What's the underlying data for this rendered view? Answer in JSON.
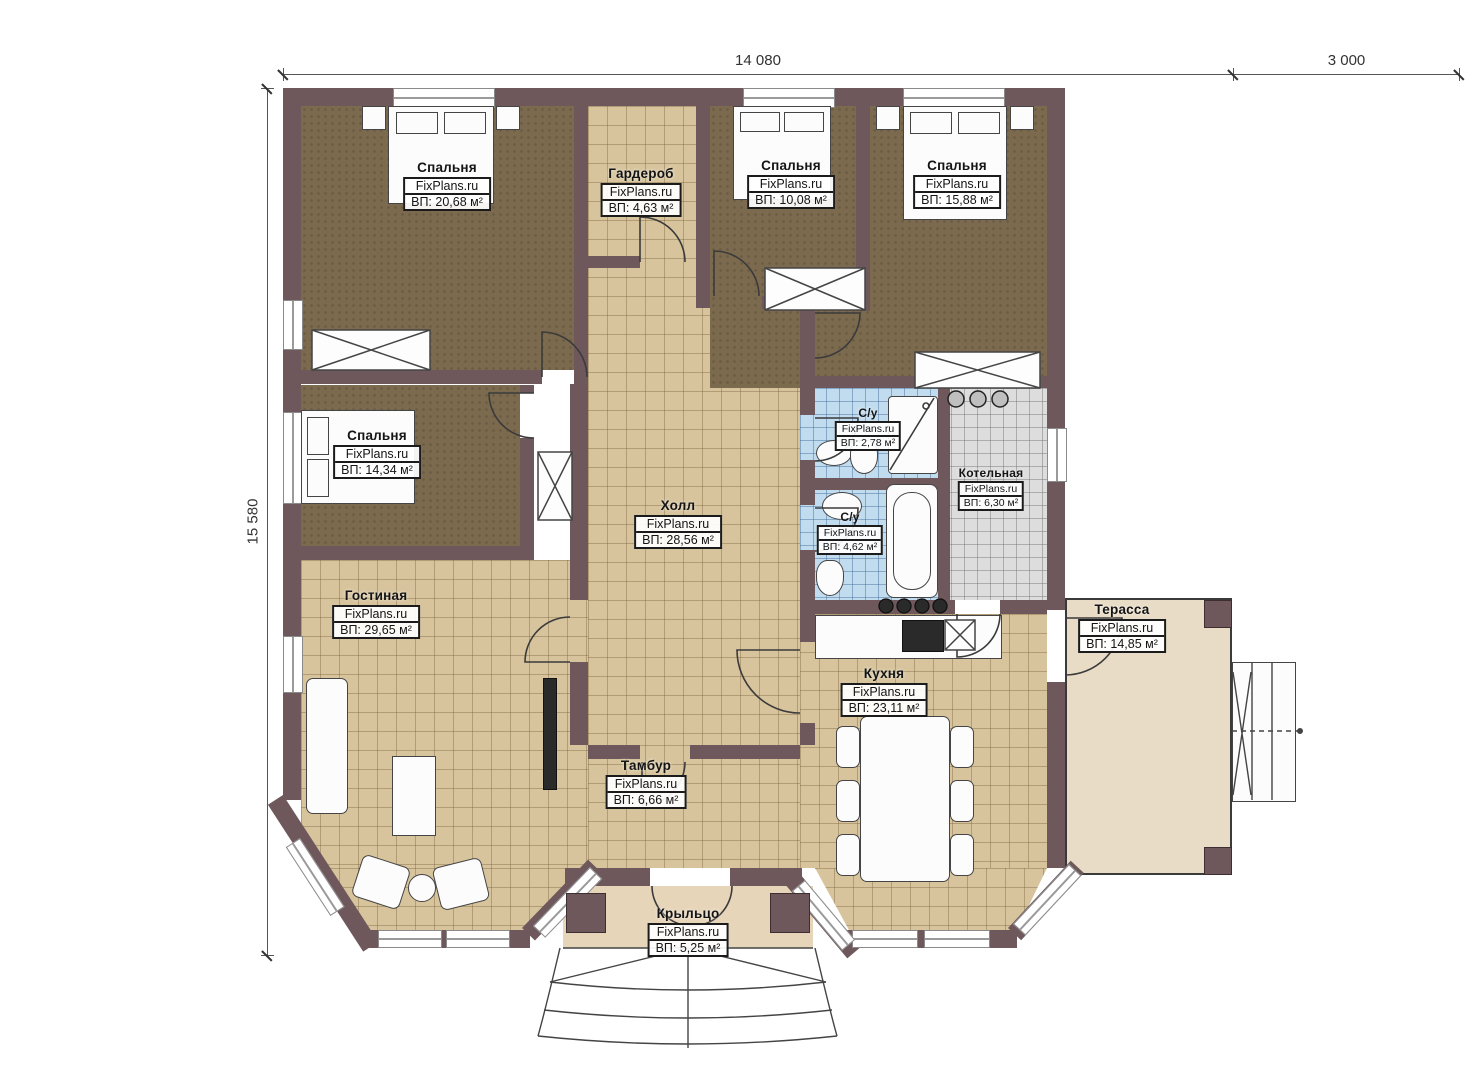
{
  "plan_title": "FixPlans.ru floor plan",
  "dimensions": {
    "top_main": "14 080",
    "top_terrace": "3 000",
    "left_height": "15 580"
  },
  "rooms": [
    {
      "id": "bedroom-top-left",
      "name": "Спальня",
      "site": "FixPlans.ru",
      "area": "ВП: 20,68 м²"
    },
    {
      "id": "wardrobe",
      "name": "Гардероб",
      "site": "FixPlans.ru",
      "area": "ВП: 4,63 м²"
    },
    {
      "id": "bedroom-top-center",
      "name": "Спальня",
      "site": "FixPlans.ru",
      "area": "ВП: 10,08 м²"
    },
    {
      "id": "bedroom-top-right",
      "name": "Спальня",
      "site": "FixPlans.ru",
      "area": "ВП: 15,88 м²"
    },
    {
      "id": "bedroom-left",
      "name": "Спальня",
      "site": "FixPlans.ru",
      "area": "ВП: 14,34 м²"
    },
    {
      "id": "hall",
      "name": "Холл",
      "site": "FixPlans.ru",
      "area": "ВП: 28,56 м²"
    },
    {
      "id": "bathroom-upper",
      "name": "С/у",
      "site": "FixPlans.ru",
      "area": "ВП: 2,78 м²"
    },
    {
      "id": "bathroom-lower",
      "name": "С/у",
      "site": "FixPlans.ru",
      "area": "ВП: 4,62 м²"
    },
    {
      "id": "boiler-room",
      "name": "Котельная",
      "site": "FixPlans.ru",
      "area": "ВП: 6,30 м²"
    },
    {
      "id": "living-room",
      "name": "Гостиная",
      "site": "FixPlans.ru",
      "area": "ВП: 29,65 м²"
    },
    {
      "id": "kitchen",
      "name": "Кухня",
      "site": "FixPlans.ru",
      "area": "ВП: 23,11 м²"
    },
    {
      "id": "vestibule",
      "name": "Тамбур",
      "site": "FixPlans.ru",
      "area": "ВП: 6,66 м²"
    },
    {
      "id": "porch",
      "name": "Крыльцо",
      "site": "FixPlans.ru",
      "area": "ВП: 5,25 м²"
    },
    {
      "id": "terrace",
      "name": "Терасса",
      "site": "FixPlans.ru",
      "area": "ВП: 14,85 м²"
    }
  ],
  "colors": {
    "wall": "#6e585c",
    "floor_tile_beige": "#d7c49c",
    "floor_carpet_dark": "#7b6a4e",
    "floor_tile_blue": "#c2dcef",
    "floor_tile_gray": "#dddddd",
    "terrace_floor": "#e8d9c0"
  }
}
